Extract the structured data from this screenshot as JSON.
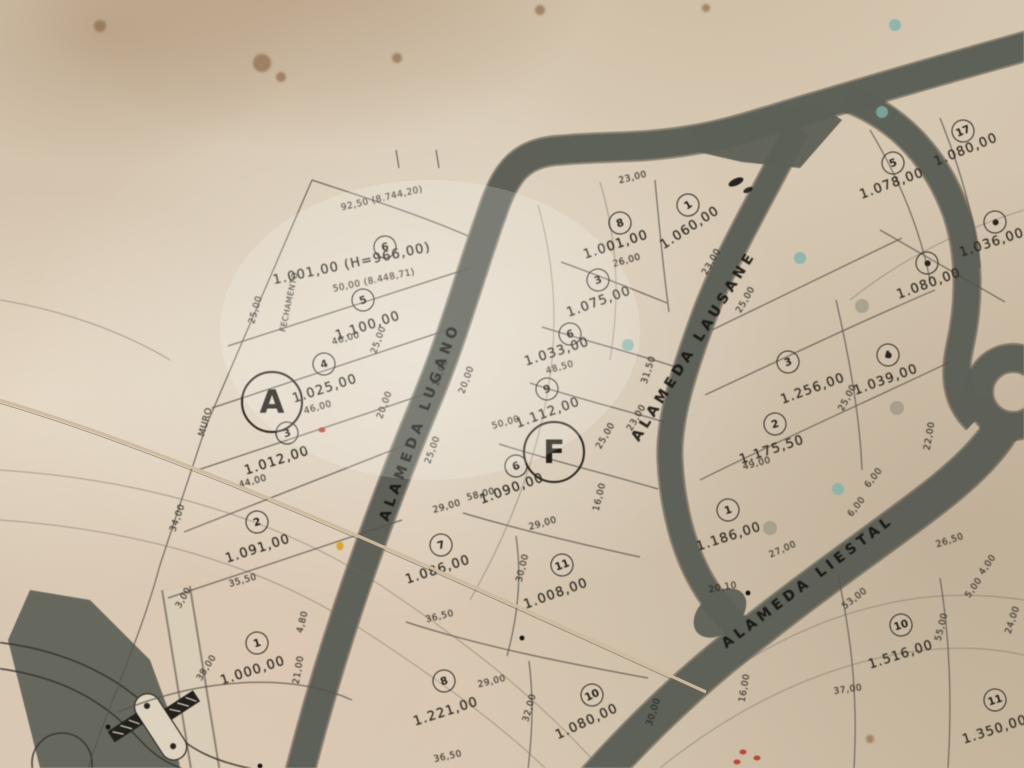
{
  "photo": {
    "description": "Photograph of a paper cadastral subdivision plat map with numbered lots, lot areas in square metres, street names and survey dimensions",
    "paper_color": "#d5c6b1",
    "road_color": "#5d6056",
    "ink_color": "#29261f"
  },
  "zones": [
    {
      "label": "A",
      "x": 272,
      "y": 402
    },
    {
      "label": "F",
      "x": 554,
      "y": 452
    }
  ],
  "streets": [
    {
      "name": "ALAMEDA LUGANO",
      "x": 420,
      "y": 422,
      "rot": -70
    },
    {
      "name": "ALAMEDA LAUSANE",
      "x": 694,
      "y": 346,
      "rot": -58
    },
    {
      "name": "ALAMEDA LIESTAL",
      "x": 808,
      "y": 582,
      "rot": -37
    }
  ],
  "lots": [
    {
      "num": "6",
      "area": "1.001,00 (H=966,00)",
      "cx": 385,
      "cy": 247,
      "ax": 352,
      "ay": 264,
      "rot": -12,
      "extra": "50,00 (8.448,71)",
      "ex": 374,
      "ey": 281
    },
    {
      "num": "5",
      "area": "1.100,00",
      "cx": 363,
      "cy": 300,
      "ax": 368,
      "ay": 326,
      "rot": -18
    },
    {
      "num": "4",
      "area": "1.025,00",
      "cx": 324,
      "cy": 364,
      "ax": 325,
      "ay": 389,
      "rot": -18
    },
    {
      "num": "3",
      "area": "1.012,00",
      "cx": 287,
      "cy": 433,
      "ax": 277,
      "ay": 461,
      "rot": -18
    },
    {
      "num": "2",
      "area": "1.091,00",
      "cx": 257,
      "cy": 522,
      "ax": 258,
      "ay": 549,
      "rot": -18
    },
    {
      "num": "1",
      "area": "1.000,00",
      "cx": 257,
      "cy": 643,
      "ax": 253,
      "ay": 671,
      "rot": -18
    },
    {
      "num": "8",
      "area": "1.001,00",
      "cx": 620,
      "cy": 223,
      "ax": 616,
      "ay": 245,
      "rot": -18
    },
    {
      "num": "1",
      "area": "1.060,00",
      "cx": 688,
      "cy": 205,
      "ax": 690,
      "ay": 228,
      "rot": -33
    },
    {
      "num": "3",
      "area": "1.075,00",
      "cx": 598,
      "cy": 280,
      "ax": 599,
      "ay": 302,
      "rot": -20
    },
    {
      "num": "6",
      "area": "1.033,00",
      "cx": 570,
      "cy": 334,
      "ax": 557,
      "ay": 352,
      "rot": -18
    },
    {
      "num": "9",
      "area": "1.112,00",
      "cx": 547,
      "cy": 389,
      "ax": 548,
      "ay": 413,
      "rot": -20
    },
    {
      "num": "6",
      "area": "1.090,00",
      "cx": 516,
      "cy": 466,
      "ax": 512,
      "ay": 489,
      "rot": -20
    },
    {
      "num": "7",
      "area": "1.086,00",
      "cx": 441,
      "cy": 545,
      "ax": 438,
      "ay": 570,
      "rot": -18
    },
    {
      "num": "11",
      "area": "1.008,00",
      "cx": 562,
      "cy": 565,
      "ax": 556,
      "ay": 594,
      "rot": -20
    },
    {
      "num": "8",
      "area": "1.221,00",
      "cx": 444,
      "cy": 681,
      "ax": 446,
      "ay": 712,
      "rot": -18
    },
    {
      "num": "10",
      "area": "1.080,00",
      "cx": 592,
      "cy": 695,
      "ax": 587,
      "ay": 722,
      "rot": -25
    },
    {
      "num": "3",
      "area": "1.256,00",
      "cx": 788,
      "cy": 362,
      "ax": 813,
      "ay": 389,
      "rot": -20
    },
    {
      "num": "2",
      "area": "1.175,50",
      "cx": 775,
      "cy": 424,
      "ax": 772,
      "ay": 450,
      "rot": -18
    },
    {
      "num": "1",
      "area": "1.186,00",
      "cx": 728,
      "cy": 510,
      "ax": 729,
      "ay": 537,
      "rot": -18
    },
    {
      "num": "4",
      "area": "1.039,00",
      "cx": 888,
      "cy": 355,
      "ax": 886,
      "ay": 380,
      "rot": -20,
      "dot": true
    },
    {
      "num": "17",
      "area": "1.080,00",
      "cx": 963,
      "cy": 131,
      "ax": 966,
      "ay": 150,
      "rot": -22
    },
    {
      "num": "5",
      "area": "1.078,00",
      "cx": 893,
      "cy": 163,
      "ax": 892,
      "ay": 184,
      "rot": -20
    },
    {
      "num": "",
      "area": "1.080,00",
      "cx": 927,
      "cy": 263,
      "ax": 929,
      "ay": 284,
      "rot": -20,
      "dot": true
    },
    {
      "num": "",
      "area": "1.036,00",
      "cx": 995,
      "cy": 222,
      "ax": 992,
      "ay": 243,
      "rot": -18,
      "dot": true
    },
    {
      "num": "10",
      "area": "1.516,00",
      "cx": 901,
      "cy": 625,
      "ax": 901,
      "ay": 655,
      "rot": -18
    },
    {
      "num": "11",
      "area": "1.350,00",
      "cx": 995,
      "cy": 700,
      "ax": 995,
      "ay": 730,
      "rot": -18
    }
  ],
  "dimensions": [
    {
      "text": "46,00",
      "x": 346,
      "y": 339,
      "rot": -16
    },
    {
      "text": "46,00",
      "x": 318,
      "y": 408,
      "rot": -16
    },
    {
      "text": "44,00",
      "x": 253,
      "y": 482,
      "rot": -16
    },
    {
      "text": "35,50",
      "x": 243,
      "y": 581,
      "rot": -16
    },
    {
      "text": "34,00",
      "x": 178,
      "y": 518,
      "rot": -70
    },
    {
      "text": "3,00",
      "x": 184,
      "y": 598,
      "rot": -60
    },
    {
      "text": "38,00",
      "x": 207,
      "y": 668,
      "rot": -58
    },
    {
      "text": "21,00",
      "x": 299,
      "y": 670,
      "rot": -80
    },
    {
      "text": "4,80",
      "x": 303,
      "y": 622,
      "rot": -76
    },
    {
      "text": "25,00",
      "x": 256,
      "y": 310,
      "rot": -74
    },
    {
      "text": "25,00",
      "x": 379,
      "y": 340,
      "rot": -70
    },
    {
      "text": "20,00",
      "x": 385,
      "y": 405,
      "rot": -70
    },
    {
      "text": "25,00",
      "x": 433,
      "y": 450,
      "rot": -70
    },
    {
      "text": "20,00",
      "x": 467,
      "y": 380,
      "rot": -70
    },
    {
      "text": "10,00",
      "x": 441,
      "y": 373,
      "rot": -70
    },
    {
      "text": "50,00",
      "x": 506,
      "y": 423,
      "rot": -16
    },
    {
      "text": "58,00",
      "x": 481,
      "y": 495,
      "rot": -14
    },
    {
      "text": "48,50",
      "x": 560,
      "y": 368,
      "rot": -16
    },
    {
      "text": "26,00",
      "x": 627,
      "y": 261,
      "rot": -16
    },
    {
      "text": "23,00",
      "x": 633,
      "y": 178,
      "rot": -14
    },
    {
      "text": "23,00",
      "x": 712,
      "y": 262,
      "rot": -60
    },
    {
      "text": "25,00",
      "x": 746,
      "y": 300,
      "rot": -60
    },
    {
      "text": "31,50",
      "x": 649,
      "y": 370,
      "rot": -72
    },
    {
      "text": "25,00",
      "x": 606,
      "y": 436,
      "rot": -60
    },
    {
      "text": "23,00",
      "x": 637,
      "y": 418,
      "rot": -60
    },
    {
      "text": "16,00",
      "x": 600,
      "y": 497,
      "rot": -76
    },
    {
      "text": "29,00",
      "x": 447,
      "y": 507,
      "rot": -16
    },
    {
      "text": "29,00",
      "x": 543,
      "y": 524,
      "rot": -16
    },
    {
      "text": "30,00",
      "x": 523,
      "y": 568,
      "rot": -76
    },
    {
      "text": "29,00",
      "x": 492,
      "y": 682,
      "rot": -14
    },
    {
      "text": "36,50",
      "x": 440,
      "y": 617,
      "rot": -14
    },
    {
      "text": "36,50",
      "x": 448,
      "y": 757,
      "rot": -12
    },
    {
      "text": "32,00",
      "x": 530,
      "y": 708,
      "rot": -74
    },
    {
      "text": "30,00",
      "x": 654,
      "y": 712,
      "rot": -72
    },
    {
      "text": "49,00",
      "x": 757,
      "y": 464,
      "rot": -15
    },
    {
      "text": "27,00",
      "x": 783,
      "y": 550,
      "rot": -24
    },
    {
      "text": "20,10",
      "x": 723,
      "y": 588,
      "rot": -10
    },
    {
      "text": "16,00",
      "x": 745,
      "y": 688,
      "rot": -80
    },
    {
      "text": "22,00",
      "x": 930,
      "y": 436,
      "rot": -80
    },
    {
      "text": "25,00",
      "x": 848,
      "y": 398,
      "rot": -62
    },
    {
      "text": "6,00",
      "x": 874,
      "y": 478,
      "rot": -52
    },
    {
      "text": "6,00",
      "x": 857,
      "y": 507,
      "rot": -52
    },
    {
      "text": "26,50",
      "x": 950,
      "y": 541,
      "rot": -18
    },
    {
      "text": "4,00",
      "x": 988,
      "y": 565,
      "rot": -55
    },
    {
      "text": "5,00",
      "x": 974,
      "y": 588,
      "rot": -55
    },
    {
      "text": "53,00",
      "x": 855,
      "y": 599,
      "rot": -38
    },
    {
      "text": "55,00",
      "x": 942,
      "y": 627,
      "rot": -76
    },
    {
      "text": "37,00",
      "x": 848,
      "y": 690,
      "rot": -8
    },
    {
      "text": "24,00",
      "x": 1013,
      "y": 620,
      "rot": -72
    }
  ],
  "annotations": [
    {
      "text": "92,50 (8.744,20)",
      "x": 382,
      "y": 199,
      "rot": -13,
      "size": 9
    },
    {
      "text": "MURO",
      "x": 206,
      "y": 422,
      "rot": -74,
      "size": 9
    },
    {
      "text": "FECHAMENTO",
      "x": 289,
      "y": 302,
      "rot": -78,
      "size": 8
    }
  ],
  "marks": {
    "teal_dots": [
      [
        800,
        258
      ],
      [
        882,
        112
      ],
      [
        628,
        345
      ],
      [
        838,
        489
      ],
      [
        895,
        25
      ]
    ],
    "gray_dots": [
      [
        862,
        306
      ],
      [
        770,
        528
      ],
      [
        897,
        408
      ]
    ],
    "brown_spots": [
      [
        262,
        63,
        9
      ],
      [
        281,
        77,
        5
      ],
      [
        100,
        26,
        6
      ],
      [
        397,
        58,
        5
      ],
      [
        540,
        10,
        5
      ],
      [
        706,
        8,
        4
      ],
      [
        870,
        739,
        4
      ]
    ],
    "red_marks": [
      [
        743,
        752
      ],
      [
        757,
        758
      ],
      [
        737,
        762
      ],
      [
        322,
        430
      ]
    ],
    "orange_dot": [
      340,
      546
    ],
    "teal_color": "#7fb2a8",
    "gray_color": "#8a8878",
    "brown_color": "#8d6b4a",
    "red_color": "#b93a2b",
    "orange_color": "#d6a21f"
  }
}
